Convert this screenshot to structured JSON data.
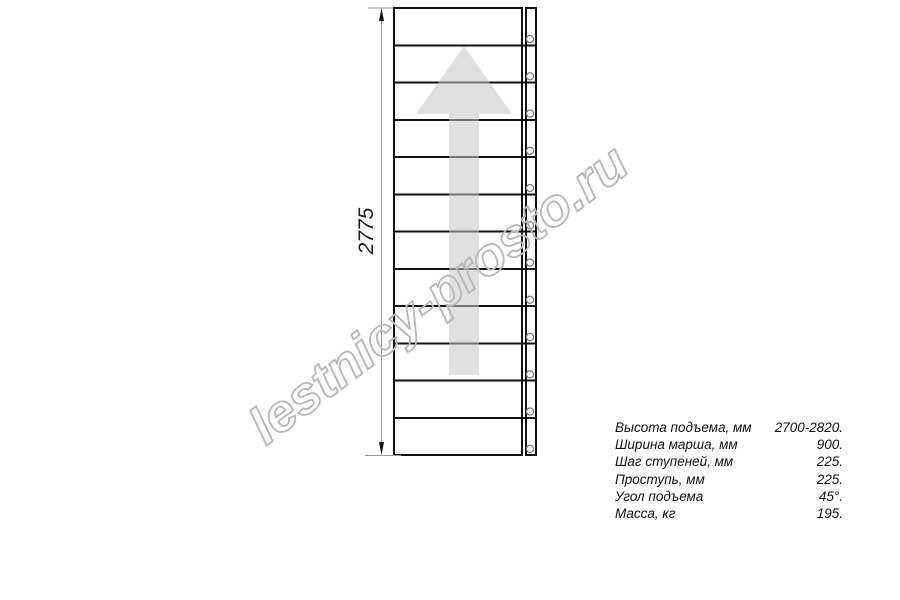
{
  "page": {
    "background": "#ffffff"
  },
  "diagram": {
    "dimension_label": "2775",
    "tread_count": 12,
    "line_color": "#111111",
    "dimension_line_color": "#999999",
    "bolt_color": "#777777",
    "arrow_fill": "rgba(198,198,198,0.55)"
  },
  "watermark": {
    "text": "lestnicy-prosto.ru",
    "color": "#b8b8b8"
  },
  "specs": {
    "rows": [
      {
        "label": "Высота подъема, мм",
        "value": "2700-2820."
      },
      {
        "label": "Ширина марша, мм",
        "value": "900."
      },
      {
        "label": "Шаг ступеней, мм",
        "value": "225."
      },
      {
        "label": "Проступь, мм",
        "value": "225."
      },
      {
        "label": "Угол подъема",
        "value": "45°."
      },
      {
        "label": "Масса, кг",
        "value": "195."
      }
    ]
  }
}
